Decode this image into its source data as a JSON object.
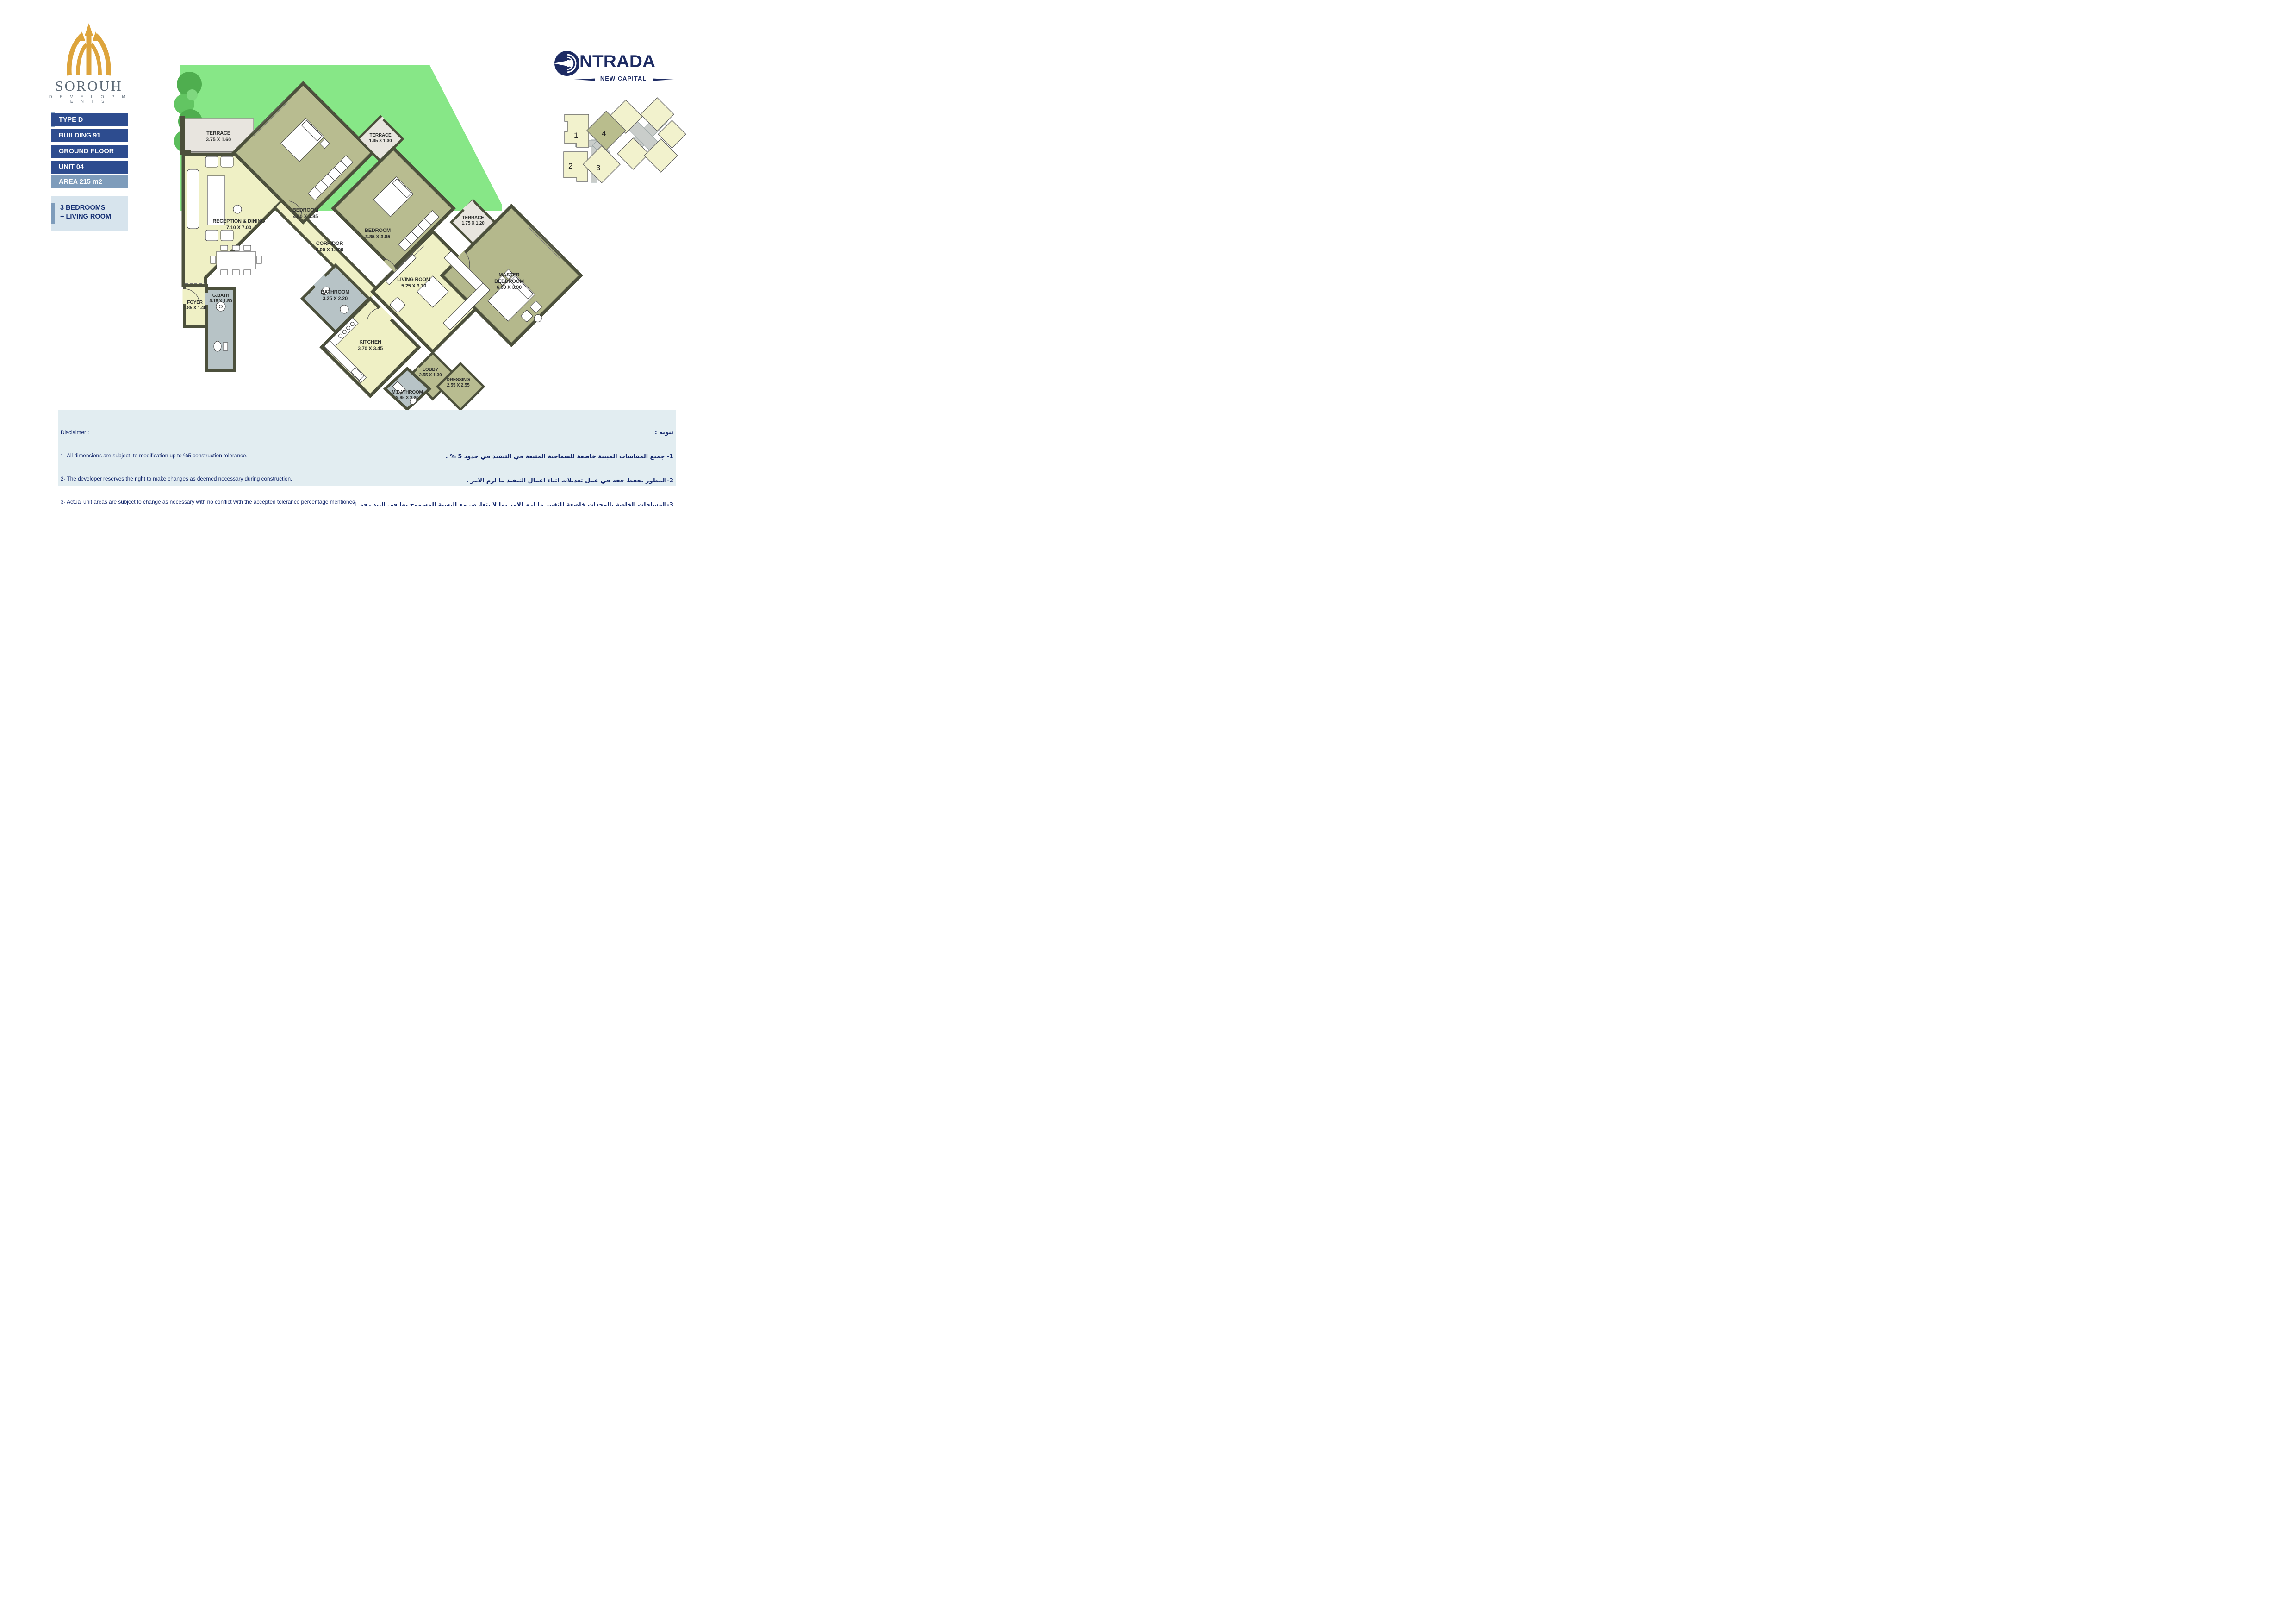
{
  "developer": {
    "name": "SOROUH",
    "subtitle": "D E V E L O P M E N T S"
  },
  "project": {
    "name": "NTRADA",
    "tagline": "NEW CAPITAL"
  },
  "sidebar": {
    "bars": [
      {
        "label": "TYPE D"
      },
      {
        "label": "BUILDING 91"
      },
      {
        "label": "GROUND FLOOR"
      },
      {
        "label": "UNIT 04"
      },
      {
        "label": "AREA  215 m2"
      }
    ],
    "summary_line1": "3 BEDROOMS",
    "summary_line2": "+ LIVING ROOM"
  },
  "key_plan": {
    "buildings": [
      {
        "num": "1"
      },
      {
        "num": "2"
      },
      {
        "num": "3"
      },
      {
        "num": "4"
      }
    ],
    "highlighted": "4"
  },
  "rooms": [
    {
      "id": "terrace-main",
      "name": "TERRACE",
      "dims": "3.75 X 1.60"
    },
    {
      "id": "bedroom-1",
      "name": "BEDROOM",
      "dims": "4.60 X 3.85"
    },
    {
      "id": "terrace-small",
      "name": "TERRACE",
      "dims": "1.35 X 1.30"
    },
    {
      "id": "bedroom-2",
      "name": "BEDROOM",
      "dims": "3.85 X 3.85"
    },
    {
      "id": "reception",
      "name": "RECEPTION & DINING",
      "dims": "7.10 X 7.00"
    },
    {
      "id": "corridor",
      "name": "CORRIDOR",
      "dims": "6.00 X 1.300"
    },
    {
      "id": "living-room",
      "name": "LIVING ROOM",
      "dims": "5.25 X 3.70"
    },
    {
      "id": "terrace-master",
      "name": "TERRACE",
      "dims": "1.75 X 1.20"
    },
    {
      "id": "master-bedroom",
      "name": "MASTER BEDDROOM",
      "dims": "6.00 X 3.90"
    },
    {
      "id": "bathroom",
      "name": "BATHROOM",
      "dims": "3.25 X 2.20"
    },
    {
      "id": "g-bath",
      "name": "G.BATH",
      "dims": "3.15 X 1.50"
    },
    {
      "id": "foyer",
      "name": "FOYER",
      "dims": "1.85 X 1.40"
    },
    {
      "id": "kitchen",
      "name": "KITCHEN",
      "dims": "3.70 X 3.45"
    },
    {
      "id": "lobby",
      "name": "LOBBY",
      "dims": "2.55 X 1.30"
    },
    {
      "id": "dressing",
      "name": "DRESSING",
      "dims": "2.55 X 2.55"
    },
    {
      "id": "m-bathroom",
      "name": "M.BATHROOM",
      "dims": "2.85 X 2.20"
    }
  ],
  "disclaimer_en": {
    "title": "Disclaimer :",
    "lines": [
      "1- All dimensions are subject  to modification up to %5 construction tolerance.",
      "2- The developer reserves the right to make changes as deemed necessary during construction.",
      "3- Actual unit areas are subject to change as necessary with no conflict with the accepted tolerance percentage mentioned",
      "    .also windows & terraces dimensions ,facade color scheme & material are subject to changes as needed ,1.in item no",
      "4- Ground floor garden areas may vary in terms of dimensions and outline according to the final building placement",
      "within the final master plan design.",
      "5- All renderings and visuals are for demonstrative purposes and are subject to changes as necessary",
      "6- All dimensions include structural elements, block works and finishes if any"
    ]
  },
  "disclaimer_ar": {
    "title": "تنويه :",
    "lines": [
      "1- جميع المقاسات المبينة خاضعة للسماحية المتبعة في التنفيذ في حدود 5 % .",
      "2-المطور يحفظ حقه في عمل تعديلات اثناء اعمال التنفيذ ما لزم الامر .",
      "3-المساحات الخاصة بالوحدات خاضعة للتغيير ما لزم الامر بما لا يتعارض مع النسبة المسموح بها في البند رقم 1 ، كذلك",
      "تخضع مقاسات الشبابيك والبلكونات وألوان وخامات الواجهات للتغيير اذا لزم الامر .",
      "4-مساحات واشكال الحدائق بالدور الارضي وكذلك مقاساتها خاضعة للتغيير بناء علي الموقع  العام النهائي  والتوقيع",
      "النهائي للمباني في الارض .",
      "5-جميع المناظير الخارجية غرضها الايضاح فقط وهي عرضه للتغيرات  اذا لزم الامر",
      "6-جميع الأبعاد تشمل العناصر الإنشائية و المبانى و التشطيبات إن وجدت"
    ]
  },
  "colors": {
    "navy_bar": "#2d4c8f",
    "area_bar": "#7e9cbb",
    "summary_panel": "#d7e4ed",
    "navy_text": "#12266b",
    "logo_gold": "#dda43c",
    "logo_gray": "#5d6a77",
    "project_navy": "#1d2b63",
    "garden_green": "#87e787",
    "room_yellow": "#eff0c5",
    "room_olive": "#b8bc90",
    "room_gray": "#b7c3c6",
    "terrace_floor": "#e8e5df",
    "wall": "#4c503c",
    "footer_panel": "#e2edf1"
  }
}
